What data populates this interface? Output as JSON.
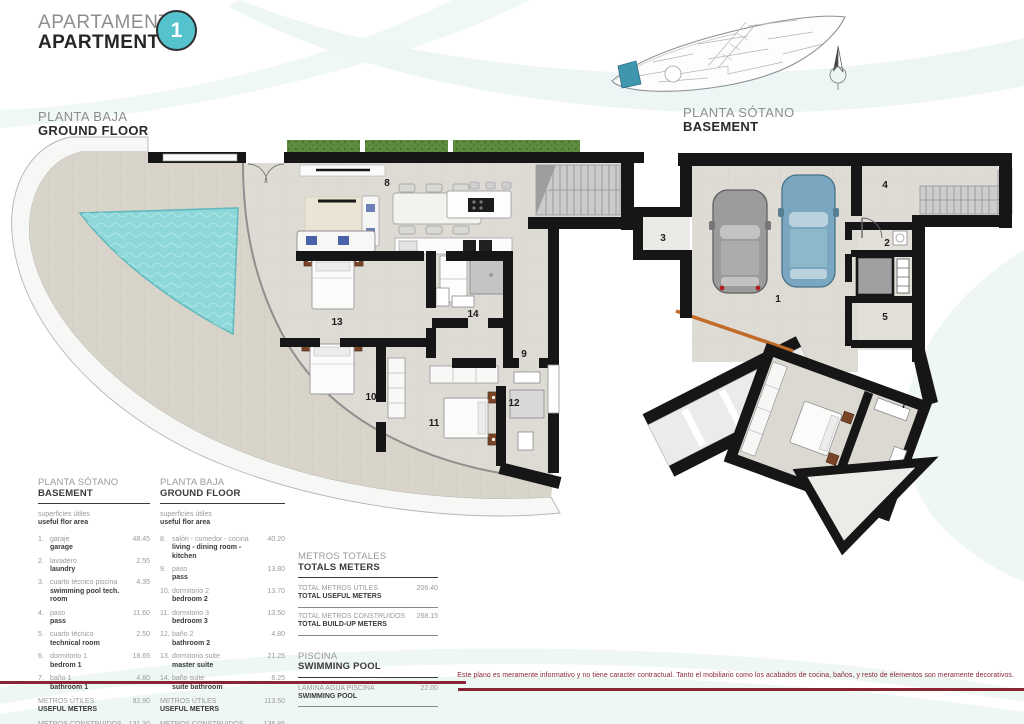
{
  "page": {
    "title_es": "APARTAMENTO",
    "title_en": "APARTMENT",
    "unit_number": "1",
    "disclaimer": "Este plano es meramente informativo y no tiene caracter contractual. Tanto el mobiliario como los acabados de cocina, baños, y resto de elementos son meramente decorativos."
  },
  "colors": {
    "accent_teal": "#54c3cd",
    "maroon": "#8a2536",
    "pool_water": "#8ed8da",
    "planter_green": "#5d8c3e",
    "site_highlight": "#3f96ad",
    "wall_black": "#161616"
  },
  "ground_floor_plan": {
    "title_es": "PLANTA BAJA",
    "title_en": "GROUND FLOOR",
    "room_numbers": [
      "8",
      "9",
      "10",
      "11",
      "12",
      "13",
      "14"
    ]
  },
  "basement_plan": {
    "title_es": "PLANTA SÓTANO",
    "title_en": "BASEMENT",
    "room_numbers": [
      "1",
      "2",
      "3",
      "4",
      "5",
      "6",
      "7"
    ]
  },
  "legend_basement": {
    "title_es": "PLANTA SÓTANO",
    "title_en": "BASEMENT",
    "subtitle_es": "superficies útiles",
    "subtitle_en": "useful flor area",
    "items": [
      {
        "num": "1.",
        "es": "garaje",
        "en": "garage",
        "value": "48.45"
      },
      {
        "num": "2.",
        "es": "lavadero",
        "en": "laundry",
        "value": "2.55"
      },
      {
        "num": "3.",
        "es": "cuarto técnico piscina",
        "en": "swimming pool tech. room",
        "value": "4.35"
      },
      {
        "num": "4.",
        "es": "paso",
        "en": "pass",
        "value": "11.60"
      },
      {
        "num": "5.",
        "es": "cuarto técnico",
        "en": "technical room",
        "value": "2.50"
      },
      {
        "num": "6.",
        "es": "dormitorio 1",
        "en": "bedrom 1",
        "value": "18.65"
      },
      {
        "num": "7.",
        "es": "baño 1",
        "en": "bathroom 1",
        "value": "4.80"
      }
    ],
    "totals": [
      {
        "es": "METROS ÚTILES",
        "en": "USEFUL METERS",
        "value": "92.90"
      },
      {
        "es": "METROS CONSTRUIDOS",
        "en": "BUILD-UP METERS",
        "value": "131.30"
      }
    ]
  },
  "legend_ground": {
    "title_es": "PLANTA BAJA",
    "title_en": "GROUND FLOOR",
    "subtitle_es": "superficies útiles",
    "subtitle_en": "useful flor area",
    "items": [
      {
        "num": "8.",
        "es": "salón - comedor - cocina",
        "en": "living - dining room - kitchen",
        "value": "40.20"
      },
      {
        "num": "9.",
        "es": "paso",
        "en": "pass",
        "value": "13.80"
      },
      {
        "num": "10.",
        "es": "dormitorio 2",
        "en": "bedroom 2",
        "value": "13.70"
      },
      {
        "num": "11.",
        "es": "dormitorio 3",
        "en": "bedroom 3",
        "value": "13.50"
      },
      {
        "num": "12.",
        "es": "baño 2",
        "en": "bathroom 2",
        "value": "4.80"
      },
      {
        "num": "13.",
        "es": "dormitorio suite",
        "en": "master suite",
        "value": "21.25"
      },
      {
        "num": "14.",
        "es": "baño suite",
        "en": "suite bathroom",
        "value": "6.25"
      }
    ],
    "totals": [
      {
        "es": "METROS ÚTILES",
        "en": "USEFUL METERS",
        "value": "113.50"
      },
      {
        "es": "METROS CONSTRUIDOS",
        "en": "BUILD-UP METERS",
        "value": "136.85"
      }
    ]
  },
  "totals_block": {
    "title_es": "METROS TOTALES",
    "title_en": "TOTALS METERS",
    "rows": [
      {
        "es": "TOTAL METROS ÚTILES",
        "en": "TOTAL USEFUL METERS",
        "value": "206.40"
      },
      {
        "es": "TOTAL METROS CONSTRUIDOS",
        "en": "TOTAL BUILD-UP METERS",
        "value": "268.15"
      }
    ]
  },
  "pool_block": {
    "title_es": "PISCINA",
    "title_en": "SWIMMING POOL",
    "rows": [
      {
        "es": "LÁMINA AGUA PISCINA",
        "en": "SWIMMING POOL",
        "value": "22.00"
      }
    ]
  }
}
